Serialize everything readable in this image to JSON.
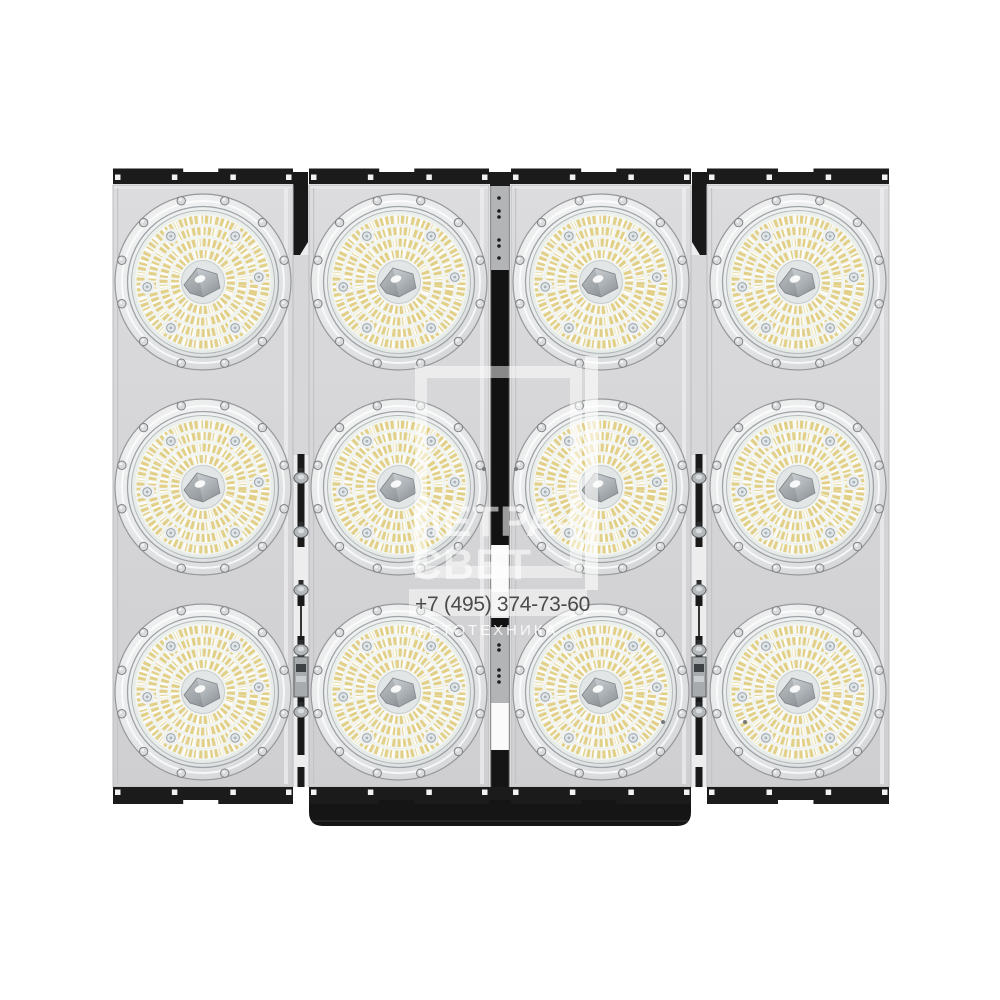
{
  "page": {
    "type": "product-photo",
    "background": "#ffffff"
  },
  "product": {
    "description": "LED high-bay floodlight array of four vertical panels with twelve round LED lens modules",
    "panel_count": 4,
    "modules_per_panel": 3,
    "module_total": 12
  },
  "watermark": {
    "brand_line1": "ПЕТРА-",
    "brand_line2": "СВЕТ",
    "phone": "+7 (495) 374-73-60",
    "subtitle": "СВЕТОТЕХНИКА"
  },
  "colors": {
    "background": "#ffffff",
    "panel_gray": "#d6d6d8",
    "bracket_black": "#1b1b1c",
    "spine_gray": "#b2b4b6",
    "led_yellow": "#e3d088",
    "led_white": "#f4f6f2",
    "lens_white": "#eef1ee",
    "rim_metal": "#d9dadb",
    "watermark_white": "rgba(255,255,255,0.58)",
    "phone_text": "#4b4b4b"
  },
  "fixture": {
    "panels": [
      {
        "x": 113,
        "w": 180
      },
      {
        "x": 309,
        "w": 180
      },
      {
        "x": 511,
        "w": 180
      },
      {
        "x": 707,
        "w": 182
      }
    ],
    "panel_top": 185,
    "panel_bottom": 787,
    "module_columns_x": [
      203,
      399,
      601,
      798
    ],
    "module_rows_y": [
      282,
      487,
      692
    ],
    "module_radius": 89,
    "rim_screw_count": 12,
    "lens_screw_count": 6,
    "led_ring_radii": [
      62.5,
      51,
      39.5,
      28,
      17
    ]
  }
}
